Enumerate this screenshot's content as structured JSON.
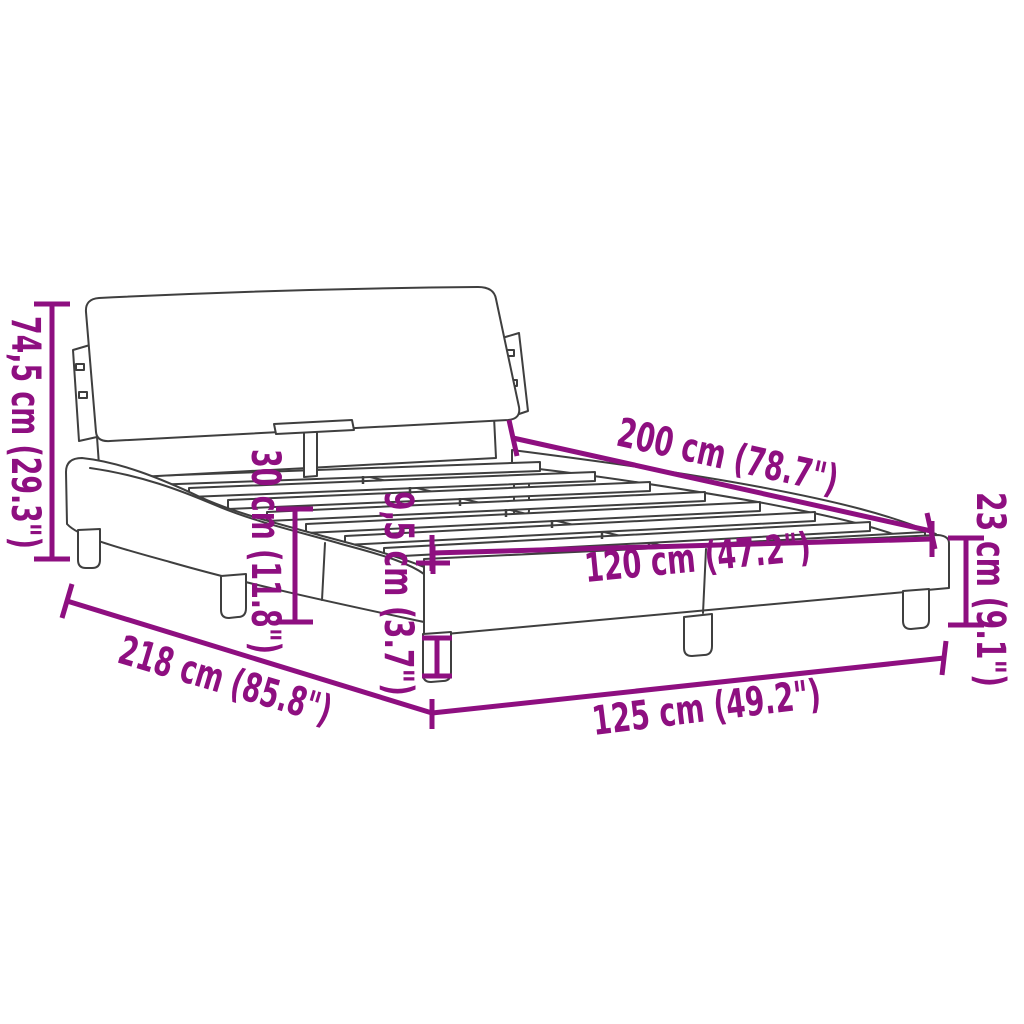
{
  "diagram": {
    "title": "bed-frame-dimension-diagram",
    "background_color": "#ffffff",
    "line_color": "#3f3f3f",
    "accent_color": "#8E0F80",
    "dimensions": {
      "headboard_height": {
        "label": "74,5 cm (29.3\")"
      },
      "bed_length": {
        "label": "200 cm (78.7\")"
      },
      "frame_height": {
        "label": "23 cm (9.1\")"
      },
      "slat_width": {
        "label": "120 cm (47.2\")"
      },
      "rail_height": {
        "label": "30 cm (11.8\")"
      },
      "leg_height": {
        "label": "9,5 cm (3.7\")"
      },
      "total_length": {
        "label": "218 cm (85.8\")"
      },
      "total_width": {
        "label": "125 cm (49.2\")"
      }
    }
  }
}
